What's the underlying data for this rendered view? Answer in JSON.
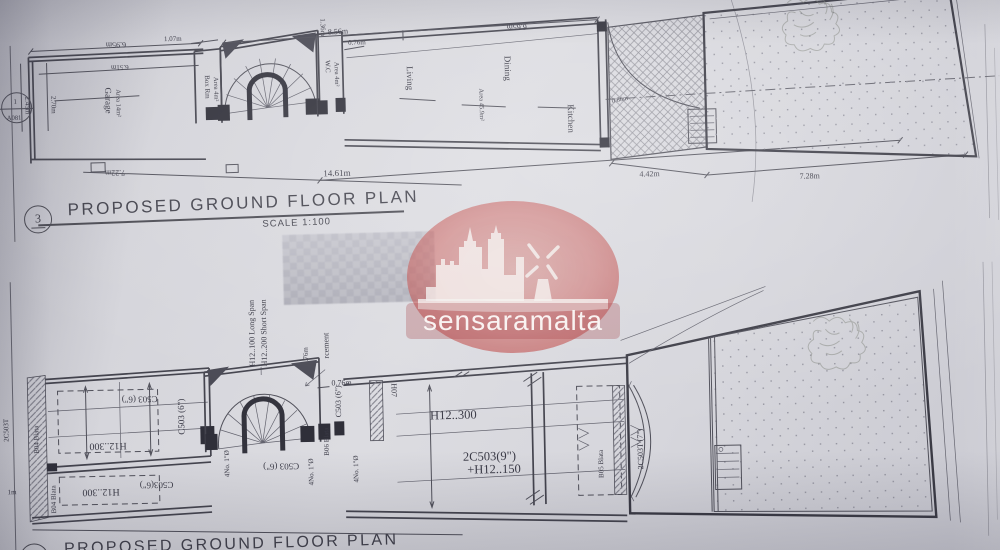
{
  "titles": {
    "plan_no": "3",
    "plan_title": "PROPOSED GROUND FLOOR PLAN",
    "plan_scale": "SCALE 1:100",
    "plan2_title": "PROPOSED GROUND FLOOR PLAN"
  },
  "watermark": {
    "brand": "sensaramalta",
    "color": "#c05a56"
  },
  "top": {
    "marker_no": "1",
    "marker_ref": "A081",
    "garage_name": "Garage",
    "garage_area": "Area 14m²",
    "boxrm_name": "Box Rm",
    "boxrm_area": "Area 4m²",
    "wc_name": "W.C",
    "wc_area": "Area 4m²",
    "living_name": "Living",
    "dining_name": "Dining",
    "dining_area": "Area 45.9m²",
    "kitchen_name": "Kitchen",
    "d_695": "6.95m",
    "d_651": "6.51m",
    "d_270": "2.70m",
    "d_245": "2.45m",
    "d_722": "7.22m",
    "d_107": "1.07m",
    "d_136": "1.36m",
    "d_856": "8.56m",
    "d_076": "0.76m",
    "d_665": "6.65m",
    "d_1461": "14.61m",
    "d_442": "4.42m",
    "d_728": "7.28m",
    "d_080": "0.80m"
  },
  "bottom": {
    "h12_100": "H12..100 Long Span",
    "h12_200": "H12..200 Short Span",
    "reinf": "rcement",
    "d_076": "0.76m",
    "c503_6": "C503 (6\")",
    "c503_6_compact": "C503(6\")",
    "h12_300": "H12..300",
    "b04": "B04 Blata",
    "b05": "B05 Blata",
    "b06": "B06 Blata",
    "h07": "H07",
    "no4": "4No. 1\"Ø",
    "c503_9": "2C503(9\")",
    "h12_150": "+H12..150",
    "c503t_7": "2C503T (7\")",
    "c503t": "2C503T",
    "d_1m": "1m"
  }
}
